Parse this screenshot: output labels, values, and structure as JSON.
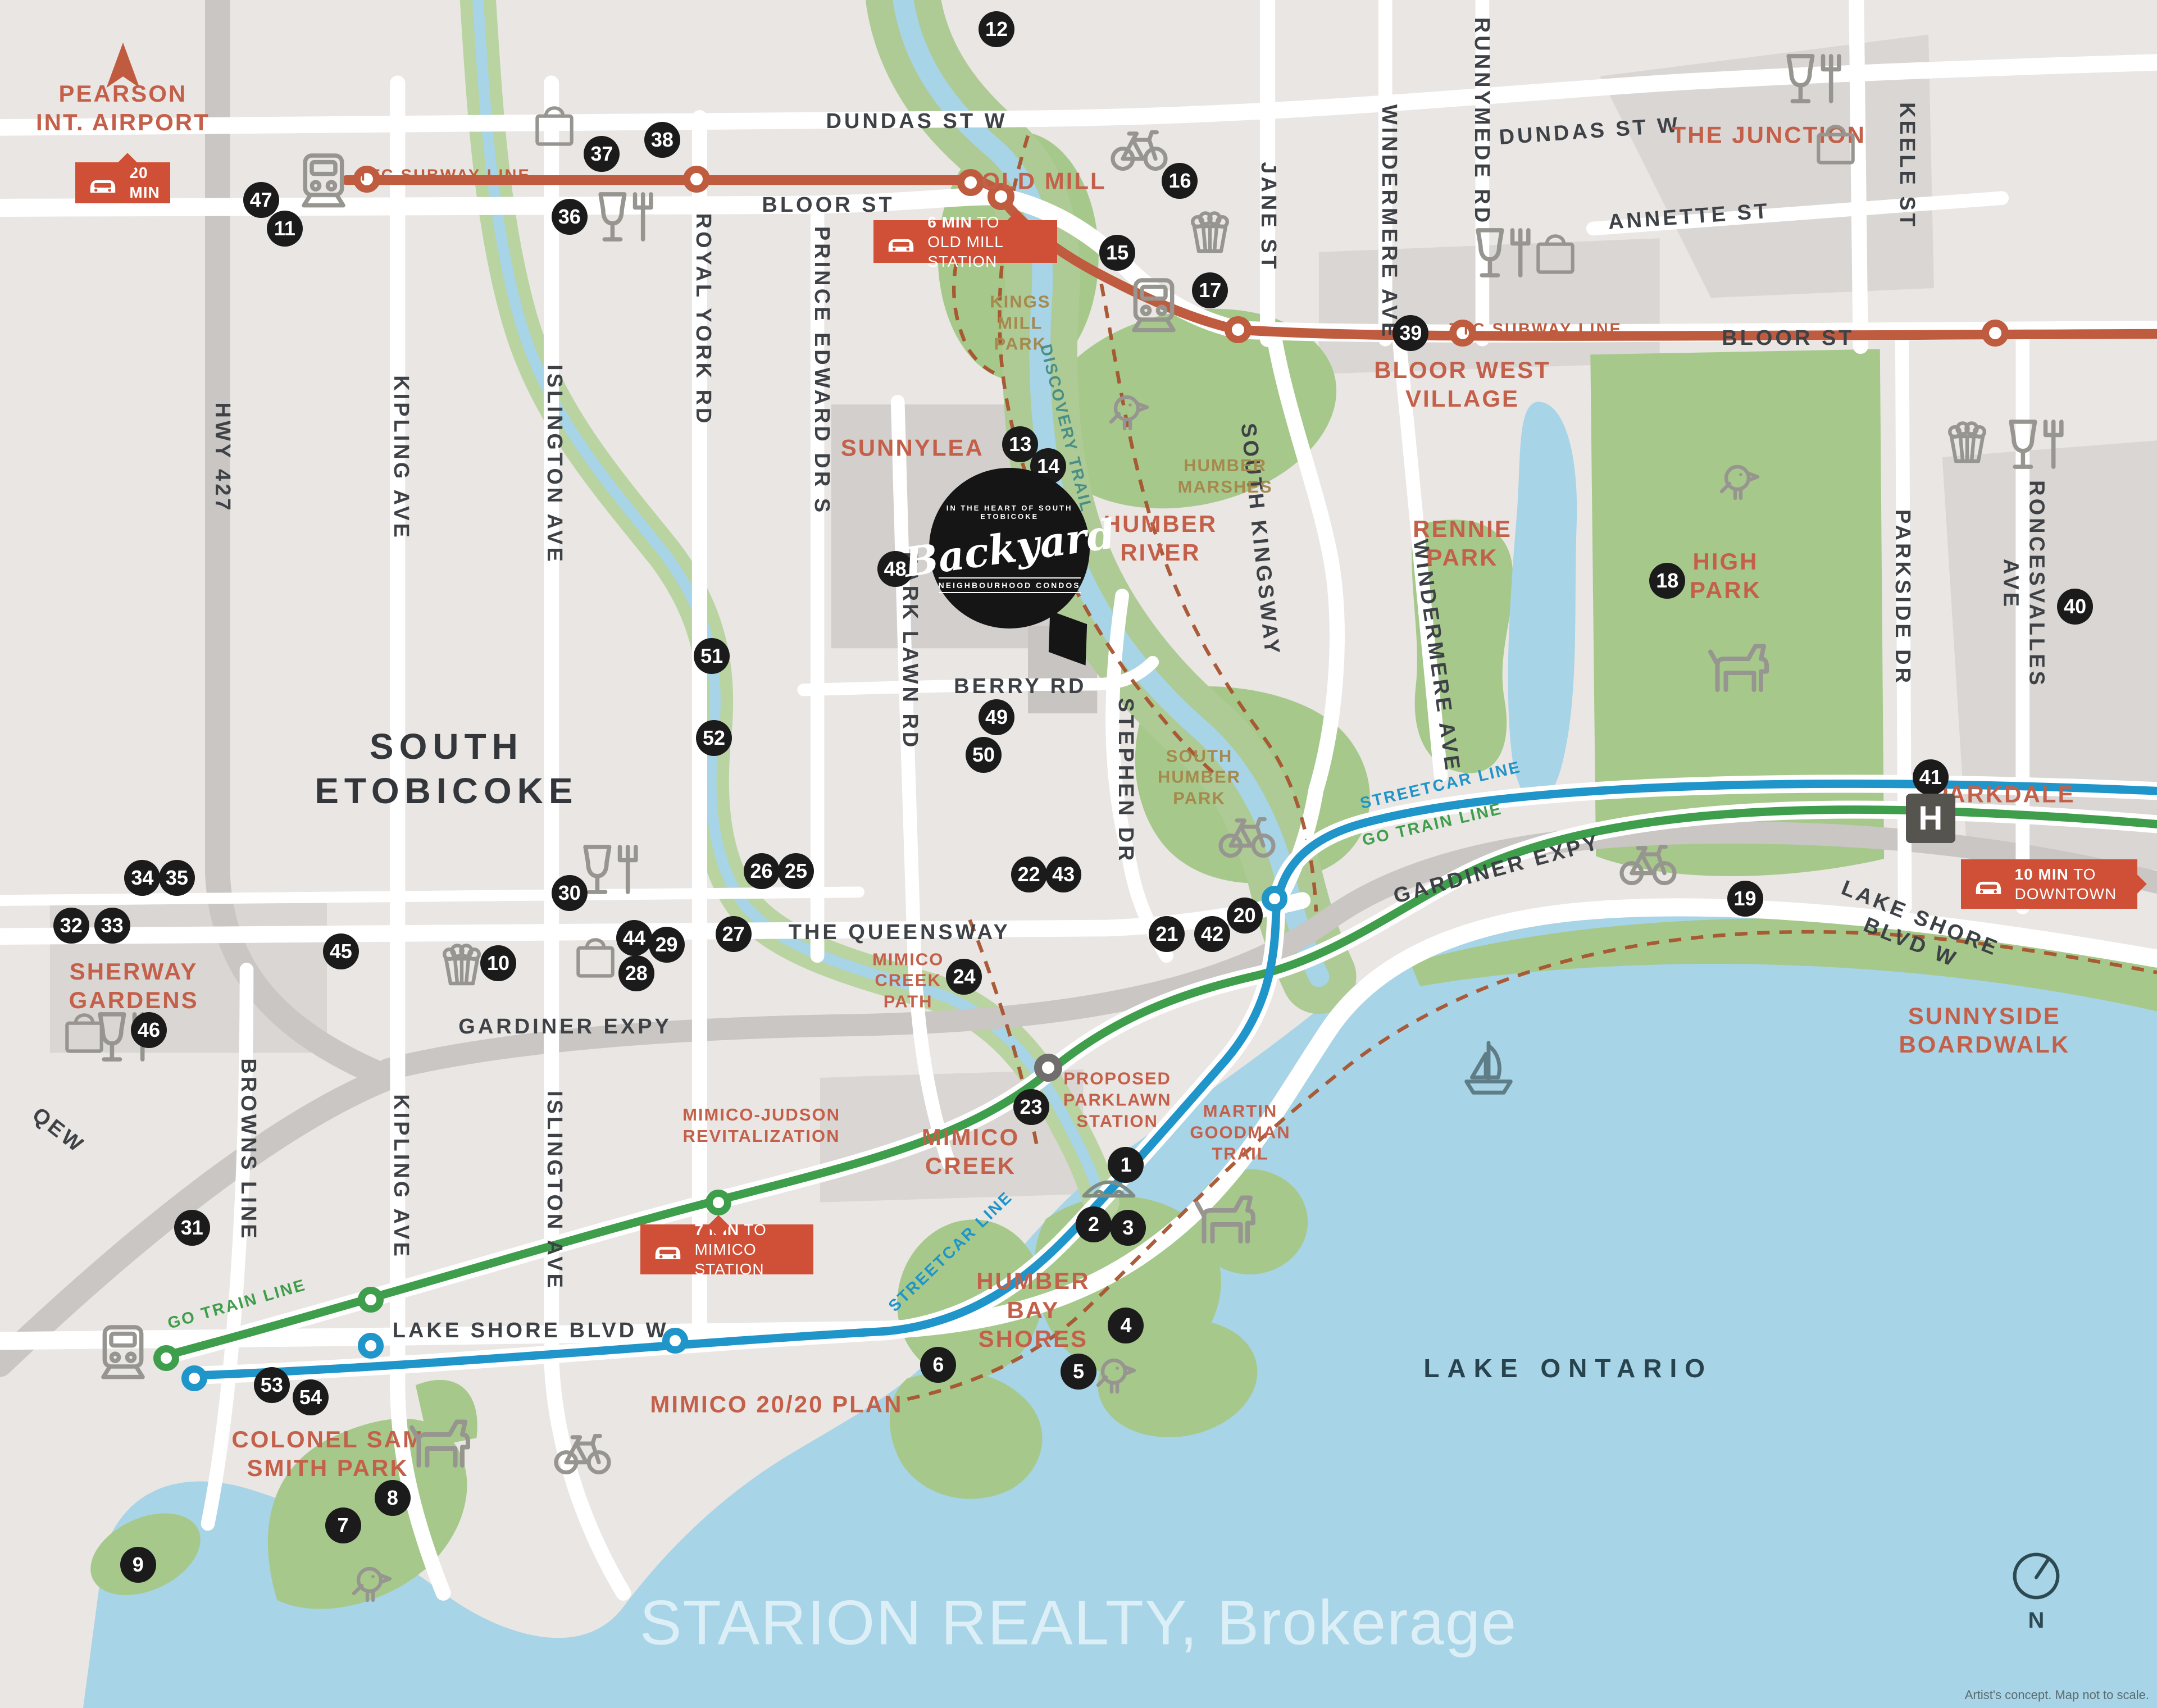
{
  "watermark": "STARION REALTY, Brokerage",
  "disclaimer": "Artist's concept. Map not to scale.",
  "compass_n": "N",
  "colors": {
    "land": "#e9e6e3",
    "block": "#d9d6d3",
    "water": "#a7d4e6",
    "green": "#a6c98b",
    "road": "#ffffff",
    "highway": "#c9c6c3",
    "ttc_line": "#bf5b3e",
    "go_line": "#3f9e4b",
    "streetcar_line": "#2095c9",
    "badge": "#cf5036",
    "marker": "#1b1b1b",
    "label_red": "#c4604a",
    "label_olive": "#a5894d",
    "label_dark": "#3e4247"
  },
  "logo": {
    "top_arc": "IN THE HEART OF SOUTH ETOBICOKE",
    "name": "Backyard",
    "bottom_arc": "NEIGHBOURHOOD CONDOS"
  },
  "labels": [
    {
      "t": "HWY 427",
      "x": 10.3,
      "y": 26.8,
      "r": 90,
      "k": "st"
    },
    {
      "t": "KIPLING AVE",
      "x": 18.6,
      "y": 26.8,
      "r": 90,
      "k": "st"
    },
    {
      "t": "KIPLING AVE",
      "x": 18.6,
      "y": 68.9,
      "r": 90,
      "k": "st"
    },
    {
      "t": "ISLINGTON AVE",
      "x": 25.7,
      "y": 27.2,
      "r": 90,
      "k": "st"
    },
    {
      "t": "ISLINGTON AVE",
      "x": 25.7,
      "y": 69.7,
      "r": 90,
      "k": "st"
    },
    {
      "t": "ROYAL YORK RD",
      "x": 32.6,
      "y": 18.7,
      "r": 90,
      "k": "st"
    },
    {
      "t": "PRINCE EDWARD DR S",
      "x": 38.1,
      "y": 21.7,
      "r": 90,
      "k": "st"
    },
    {
      "t": "PARK LAWN RD",
      "x": 42.2,
      "y": 38.1,
      "r": 90,
      "k": "st"
    },
    {
      "t": "STEPHEN DR",
      "x": 52.2,
      "y": 45.7,
      "r": 90,
      "k": "st"
    },
    {
      "t": "SOUTH KINGSWAY",
      "x": 58.4,
      "y": 31.6,
      "r": 84,
      "k": "st"
    },
    {
      "t": "WINDERMERE AVE",
      "x": 64.4,
      "y": 13.0,
      "r": 90,
      "k": "st"
    },
    {
      "t": "WINDERMERE AVE",
      "x": 66.6,
      "y": 38.4,
      "r": 82,
      "k": "st"
    },
    {
      "t": "JANE ST",
      "x": 58.8,
      "y": 12.7,
      "r": 90,
      "k": "st"
    },
    {
      "t": "RUNNYMEDE RD",
      "x": 68.7,
      "y": 7.1,
      "r": 90,
      "k": "st"
    },
    {
      "t": "KEELE ST",
      "x": 88.4,
      "y": 9.7,
      "r": 90,
      "k": "st"
    },
    {
      "t": "PARKSIDE DR",
      "x": 88.2,
      "y": 35.0,
      "r": 90,
      "k": "st"
    },
    {
      "t": "RONCESVALLES AVE",
      "x": 93.8,
      "y": 34.2,
      "r": 90,
      "k": "st"
    },
    {
      "t": "BROWNS LINE",
      "x": 11.5,
      "y": 67.3,
      "r": 90,
      "k": "st"
    },
    {
      "t": "DUNDAS ST W",
      "x": 42.5,
      "y": 7.1,
      "r": 0,
      "k": "st"
    },
    {
      "t": "DUNDAS ST W",
      "x": 73.7,
      "y": 7.7,
      "r": -4,
      "k": "st"
    },
    {
      "t": "BLOOR ST",
      "x": 38.4,
      "y": 12.0,
      "r": 0,
      "k": "st"
    },
    {
      "t": "BLOOR ST",
      "x": 82.9,
      "y": 19.8,
      "r": 0,
      "k": "st"
    },
    {
      "t": "ANNETTE ST",
      "x": 78.3,
      "y": 12.7,
      "r": -4,
      "k": "st"
    },
    {
      "t": "BERRY RD",
      "x": 47.3,
      "y": 40.2,
      "r": 0,
      "k": "st"
    },
    {
      "t": "THE QUEENSWAY",
      "x": 41.7,
      "y": 54.6,
      "r": 0,
      "k": "st"
    },
    {
      "t": "GARDINER EXPY",
      "x": 26.2,
      "y": 60.1,
      "r": 0,
      "k": "st"
    },
    {
      "t": "GARDINER EXPY",
      "x": 69.4,
      "y": 50.9,
      "r": -15,
      "k": "st"
    },
    {
      "t": "LAKE SHORE BLVD W",
      "x": 24.6,
      "y": 77.9,
      "r": 0,
      "k": "st"
    },
    {
      "t": "LAKE SHORE BLVD W",
      "x": 88.8,
      "y": 54.5,
      "r": 22,
      "k": "st"
    },
    {
      "t": "QEW",
      "x": 2.7,
      "y": 66.2,
      "r": 38,
      "k": "st"
    },
    {
      "t": "SOUTH\nETOBICOKE",
      "x": 20.7,
      "y": 45.0,
      "r": 0,
      "k": "big"
    },
    {
      "t": "LAKE ONTARIO",
      "x": 72.7,
      "y": 80.1,
      "r": 0,
      "k": "lake"
    },
    {
      "t": "PEARSON\nINT. AIRPORT",
      "x": 5.7,
      "y": 6.3,
      "r": 0,
      "k": "red"
    },
    {
      "t": "OLD MILL",
      "x": 48.4,
      "y": 10.6,
      "r": 0,
      "k": "red"
    },
    {
      "t": "THE JUNCTION",
      "x": 82.0,
      "y": 7.9,
      "r": 0,
      "k": "red"
    },
    {
      "t": "BLOOR WEST\nVILLAGE",
      "x": 67.8,
      "y": 22.5,
      "r": 0,
      "k": "red"
    },
    {
      "t": "SUNNYLEA",
      "x": 42.3,
      "y": 26.2,
      "r": 0,
      "k": "red"
    },
    {
      "t": "HUMBER\nRIVER",
      "x": 53.8,
      "y": 31.5,
      "r": 0,
      "k": "red"
    },
    {
      "t": "RENNIE\nPARK",
      "x": 67.8,
      "y": 31.8,
      "r": 0,
      "k": "red"
    },
    {
      "t": "HIGH\nPARK",
      "x": 80.0,
      "y": 33.7,
      "r": 0,
      "k": "red"
    },
    {
      "t": "PARKDALE",
      "x": 92.9,
      "y": 46.5,
      "r": 0,
      "k": "red"
    },
    {
      "t": "SHERWAY\nGARDENS",
      "x": 6.2,
      "y": 57.7,
      "r": 0,
      "k": "red"
    },
    {
      "t": "SUNNYSIDE\nBOARDWALK",
      "x": 92.0,
      "y": 60.3,
      "r": 0,
      "k": "red"
    },
    {
      "t": "MIMICO-JUDSON\nREVITALIZATION",
      "x": 35.3,
      "y": 65.9,
      "r": 0,
      "k": "redsm"
    },
    {
      "t": "MIMICO\nCREEK",
      "x": 45.0,
      "y": 67.4,
      "r": 0,
      "k": "red"
    },
    {
      "t": "MARTIN\nGOODMAN\nTRAIL",
      "x": 57.5,
      "y": 66.3,
      "r": 0,
      "k": "redsm"
    },
    {
      "t": "HUMBER\nBAY\nSHORES",
      "x": 47.9,
      "y": 76.7,
      "r": 0,
      "k": "red"
    },
    {
      "t": "COLONEL SAM\nSMITH PARK",
      "x": 15.2,
      "y": 85.1,
      "r": 0,
      "k": "red"
    },
    {
      "t": "MIMICO 20/20 PLAN",
      "x": 36.0,
      "y": 82.2,
      "r": 0,
      "k": "red"
    },
    {
      "t": "PROPOSED\nPARKLAWN\nSTATION",
      "x": 51.8,
      "y": 64.4,
      "r": 0,
      "k": "redsm"
    },
    {
      "t": "MIMICO\nCREEK\nPATH",
      "x": 42.1,
      "y": 57.4,
      "r": 0,
      "k": "redsm"
    },
    {
      "t": "KINGS\nMILL\nPARK",
      "x": 47.3,
      "y": 18.9,
      "r": 0,
      "k": "olive"
    },
    {
      "t": "HUMBER\nMARSHES",
      "x": 56.8,
      "y": 27.9,
      "r": 0,
      "k": "olive"
    },
    {
      "t": "SOUTH\nHUMBER\nPARK",
      "x": 55.6,
      "y": 45.5,
      "r": 0,
      "k": "olive"
    },
    {
      "t": "TTC SUBWAY LINE",
      "x": 20.6,
      "y": 10.3,
      "r": 0,
      "k": "ttc"
    },
    {
      "t": "TTC SUBWAY LINE",
      "x": 71.2,
      "y": 19.3,
      "r": 0,
      "k": "ttc"
    },
    {
      "t": "GO TRAIN LINE",
      "x": 11.0,
      "y": 76.4,
      "r": -16,
      "k": "go"
    },
    {
      "t": "GO TRAIN LINE",
      "x": 66.4,
      "y": 48.3,
      "r": -13,
      "k": "go"
    },
    {
      "t": "STREETCAR LINE",
      "x": 44.1,
      "y": 73.3,
      "r": -44,
      "k": "sc"
    },
    {
      "t": "STREETCAR LINE",
      "x": 66.8,
      "y": 46.0,
      "r": -13,
      "k": "sc"
    },
    {
      "t": "DISCOVERY TRAIL",
      "x": 49.4,
      "y": 25.1,
      "r": 76,
      "k": "teal"
    }
  ],
  "markers": [
    [
      1,
      52.2,
      68.2
    ],
    [
      2,
      50.7,
      71.7
    ],
    [
      3,
      52.3,
      71.9
    ],
    [
      4,
      52.2,
      77.6
    ],
    [
      5,
      50.0,
      80.3
    ],
    [
      6,
      43.5,
      79.9
    ],
    [
      7,
      15.9,
      89.3
    ],
    [
      8,
      18.2,
      87.7
    ],
    [
      9,
      6.4,
      91.6
    ],
    [
      10,
      23.1,
      56.4
    ],
    [
      11,
      13.2,
      13.4
    ],
    [
      12,
      46.2,
      1.7
    ],
    [
      13,
      47.3,
      26.0
    ],
    [
      14,
      48.6,
      27.3
    ],
    [
      15,
      51.8,
      14.8
    ],
    [
      16,
      54.7,
      10.6
    ],
    [
      17,
      56.1,
      17.0
    ],
    [
      18,
      77.3,
      34.0
    ],
    [
      19,
      80.9,
      52.6
    ],
    [
      20,
      57.7,
      53.6
    ],
    [
      21,
      54.1,
      54.7
    ],
    [
      22,
      47.7,
      51.2
    ],
    [
      23,
      47.8,
      64.8
    ],
    [
      24,
      44.7,
      57.2
    ],
    [
      25,
      36.9,
      51.0
    ],
    [
      26,
      35.3,
      51.0
    ],
    [
      27,
      34.0,
      54.7
    ],
    [
      28,
      29.5,
      57.0
    ],
    [
      29,
      30.9,
      55.3
    ],
    [
      30,
      26.4,
      52.3
    ],
    [
      31,
      8.9,
      71.9
    ],
    [
      32,
      3.3,
      54.2
    ],
    [
      33,
      5.2,
      54.2
    ],
    [
      34,
      6.6,
      51.4
    ],
    [
      35,
      8.2,
      51.4
    ],
    [
      36,
      26.4,
      12.7
    ],
    [
      37,
      27.9,
      9.0
    ],
    [
      38,
      30.7,
      8.2
    ],
    [
      39,
      65.4,
      19.5
    ],
    [
      40,
      96.2,
      35.5
    ],
    [
      41,
      89.5,
      45.5
    ],
    [
      42,
      56.2,
      54.7
    ],
    [
      43,
      49.3,
      51.2
    ],
    [
      44,
      29.4,
      54.9
    ],
    [
      45,
      15.8,
      55.7
    ],
    [
      46,
      6.9,
      60.3
    ],
    [
      47,
      12.1,
      11.7
    ],
    [
      48,
      41.5,
      33.3
    ],
    [
      49,
      46.2,
      42.0
    ],
    [
      50,
      45.6,
      44.2
    ],
    [
      51,
      33.0,
      38.4
    ],
    [
      52,
      33.1,
      43.2
    ],
    [
      53,
      12.6,
      81.1
    ],
    [
      54,
      14.4,
      81.8
    ]
  ],
  "icons": [
    [
      "bag",
      25.7,
      7.3
    ],
    [
      "bag",
      72.1,
      14.8
    ],
    [
      "bag",
      85.1,
      8.4
    ],
    [
      "bag",
      3.9,
      60.4
    ],
    [
      "bag",
      27.6,
      56.0
    ],
    [
      "wine",
      29.0,
      12.7
    ],
    [
      "wine",
      69.7,
      14.8
    ],
    [
      "wine",
      84.1,
      4.6
    ],
    [
      "wine",
      94.4,
      26.0
    ],
    [
      "wine",
      28.3,
      50.9
    ],
    [
      "wine",
      5.8,
      60.7
    ],
    [
      "popcorn",
      56.1,
      13.5
    ],
    [
      "popcorn",
      91.2,
      25.8
    ],
    [
      "popcorn",
      21.4,
      56.4
    ],
    [
      "bike",
      52.8,
      8.5
    ],
    [
      "bike",
      57.8,
      48.7
    ],
    [
      "bike",
      76.4,
      50.3
    ],
    [
      "bike",
      27.0,
      84.8
    ],
    [
      "bird",
      52.3,
      23.9
    ],
    [
      "bird",
      80.6,
      28.0
    ],
    [
      "bird",
      51.7,
      80.3
    ],
    [
      "bird",
      17.2,
      92.5
    ],
    [
      "dog",
      80.6,
      38.9
    ],
    [
      "dog",
      56.8,
      71.2
    ],
    [
      "dog",
      20.4,
      84.3
    ],
    [
      "train",
      15.0,
      10.5
    ],
    [
      "train",
      53.5,
      17.8
    ],
    [
      "train",
      5.7,
      79.1
    ],
    [
      "bridge",
      51.4,
      69.3
    ],
    [
      "sail",
      69.0,
      62.5
    ],
    [
      "arrow",
      5.7,
      3.8
    ]
  ],
  "stations": {
    "ttc": [
      [
        17.0,
        10.5
      ],
      [
        32.3,
        10.5
      ],
      [
        45.0,
        10.7
      ],
      [
        46.4,
        11.5
      ],
      [
        57.4,
        19.3
      ],
      [
        67.8,
        19.5
      ],
      [
        92.5,
        19.5
      ]
    ],
    "go": [
      [
        7.7,
        79.5
      ],
      [
        17.2,
        76.1
      ],
      [
        33.3,
        70.4
      ]
    ],
    "sc": [
      [
        9.0,
        80.7
      ],
      [
        17.2,
        78.8
      ],
      [
        31.3,
        78.5
      ],
      [
        59.1,
        52.6
      ]
    ],
    "proposed": [
      [
        48.6,
        62.5
      ]
    ]
  },
  "badges": [
    {
      "id": "pearson-20-min",
      "x": 3.5,
      "y": 9.5,
      "w": 4.4,
      "h": 2.4,
      "ptr": "top",
      "px": 55,
      "lines": [
        {
          "b": "20 MIN",
          "r": ""
        }
      ]
    },
    {
      "id": "old-mill-6-min",
      "x": 40.5,
      "y": 12.9,
      "w": 8.5,
      "h": 2.5,
      "ptr": "top",
      "px": 78,
      "lines": [
        {
          "b": "6 MIN",
          "r": " TO"
        },
        {
          "b": "",
          "r": "OLD MILL STATION"
        }
      ]
    },
    {
      "id": "mimico-7-min",
      "x": 29.7,
      "y": 71.7,
      "w": 8.0,
      "h": 2.9,
      "ptr": "top",
      "px": 45,
      "lines": [
        {
          "b": "7 MIN",
          "r": " TO"
        },
        {
          "b": "",
          "r": "MIMICO STATION"
        }
      ]
    },
    {
      "id": "downtown-10-min",
      "x": 90.9,
      "y": 50.3,
      "w": 8.2,
      "h": 2.9,
      "ptr": "right",
      "px": 50,
      "lines": [
        {
          "b": "10 MIN",
          "r": " TO"
        },
        {
          "b": "",
          "r": "DOWNTOWN"
        }
      ]
    }
  ],
  "hospital_label": "H"
}
